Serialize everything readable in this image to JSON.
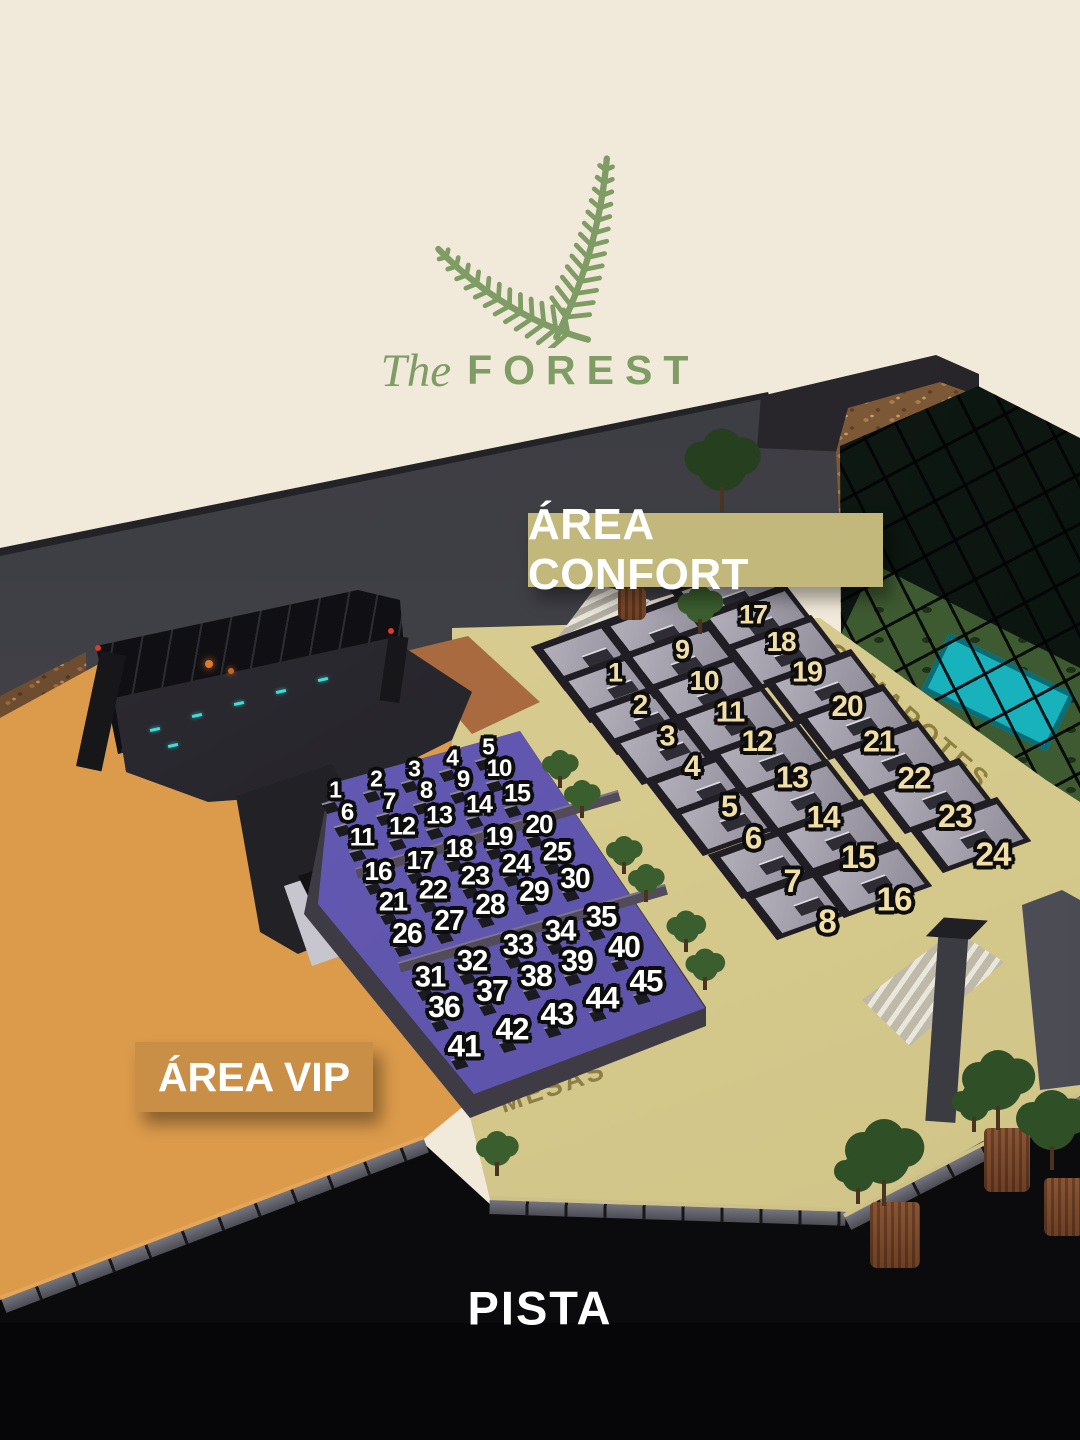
{
  "brand": {
    "prefix": "The",
    "name": "FOREST"
  },
  "banners": {
    "confort": "ÁREA CONFORT",
    "vip": "ÁREA VIP"
  },
  "floor_labels": {
    "camarotes": "CAMAROTES",
    "mesas": "MESAS",
    "pista": "PISTA"
  },
  "colors": {
    "background_cream": "#f1e9d9",
    "brand_green": "#7e9c64",
    "confort_banner": "#c3b87c",
    "vip_banner": "#c98f47",
    "orange_floor": "#dc9b4b",
    "purple_floor": "#6459b4",
    "beige_floor": "#d5c98c",
    "confort_number": "#f2dfa5",
    "vip_number": "#ffffff",
    "pista_black": "#0b0b0e",
    "pool_teal": "#18b2bc"
  },
  "vip_area": {
    "label": "ÁREA VIP",
    "tables": [
      {
        "n": 1,
        "x": 335,
        "y": 790
      },
      {
        "n": 2,
        "x": 376,
        "y": 779
      },
      {
        "n": 3,
        "x": 414,
        "y": 769
      },
      {
        "n": 4,
        "x": 452,
        "y": 758
      },
      {
        "n": 5,
        "x": 488,
        "y": 747
      },
      {
        "n": 6,
        "x": 347,
        "y": 813
      },
      {
        "n": 7,
        "x": 389,
        "y": 802
      },
      {
        "n": 8,
        "x": 426,
        "y": 791
      },
      {
        "n": 9,
        "x": 463,
        "y": 780
      },
      {
        "n": 10,
        "x": 499,
        "y": 769
      },
      {
        "n": 11,
        "x": 362,
        "y": 838
      },
      {
        "n": 12,
        "x": 402,
        "y": 827
      },
      {
        "n": 13,
        "x": 439,
        "y": 816
      },
      {
        "n": 14,
        "x": 479,
        "y": 805
      },
      {
        "n": 15,
        "x": 517,
        "y": 794
      },
      {
        "n": 16,
        "x": 378,
        "y": 871
      },
      {
        "n": 17,
        "x": 420,
        "y": 860
      },
      {
        "n": 18,
        "x": 459,
        "y": 848
      },
      {
        "n": 19,
        "x": 499,
        "y": 836
      },
      {
        "n": 20,
        "x": 539,
        "y": 824
      },
      {
        "n": 21,
        "x": 393,
        "y": 901
      },
      {
        "n": 22,
        "x": 433,
        "y": 889
      },
      {
        "n": 23,
        "x": 475,
        "y": 875
      },
      {
        "n": 24,
        "x": 516,
        "y": 863
      },
      {
        "n": 25,
        "x": 557,
        "y": 851
      },
      {
        "n": 26,
        "x": 407,
        "y": 933
      },
      {
        "n": 27,
        "x": 449,
        "y": 920
      },
      {
        "n": 28,
        "x": 490,
        "y": 904
      },
      {
        "n": 29,
        "x": 534,
        "y": 891
      },
      {
        "n": 30,
        "x": 575,
        "y": 878
      },
      {
        "n": 31,
        "x": 430,
        "y": 977
      },
      {
        "n": 32,
        "x": 472,
        "y": 961
      },
      {
        "n": 33,
        "x": 518,
        "y": 945
      },
      {
        "n": 34,
        "x": 560,
        "y": 931
      },
      {
        "n": 35,
        "x": 601,
        "y": 917
      },
      {
        "n": 36,
        "x": 444,
        "y": 1008
      },
      {
        "n": 37,
        "x": 492,
        "y": 992
      },
      {
        "n": 38,
        "x": 536,
        "y": 977
      },
      {
        "n": 39,
        "x": 577,
        "y": 962
      },
      {
        "n": 40,
        "x": 624,
        "y": 948
      },
      {
        "n": 41,
        "x": 464,
        "y": 1046
      },
      {
        "n": 42,
        "x": 512,
        "y": 1029
      },
      {
        "n": 43,
        "x": 557,
        "y": 1014
      },
      {
        "n": 44,
        "x": 602,
        "y": 998
      },
      {
        "n": 45,
        "x": 646,
        "y": 981
      }
    ]
  },
  "confort_area": {
    "label": "ÁREA CONFORT",
    "tables": [
      {
        "n": 1,
        "x": 615,
        "y": 673
      },
      {
        "n": 2,
        "x": 640,
        "y": 705
      },
      {
        "n": 3,
        "x": 667,
        "y": 737
      },
      {
        "n": 4,
        "x": 692,
        "y": 767
      },
      {
        "n": 5,
        "x": 729,
        "y": 807
      },
      {
        "n": 6,
        "x": 753,
        "y": 838
      },
      {
        "n": 7,
        "x": 792,
        "y": 881
      },
      {
        "n": 8,
        "x": 827,
        "y": 922
      },
      {
        "n": 9,
        "x": 682,
        "y": 650
      },
      {
        "n": 10,
        "x": 704,
        "y": 681
      },
      {
        "n": 11,
        "x": 730,
        "y": 713
      },
      {
        "n": 12,
        "x": 757,
        "y": 742
      },
      {
        "n": 13,
        "x": 792,
        "y": 778
      },
      {
        "n": 14,
        "x": 823,
        "y": 817
      },
      {
        "n": 15,
        "x": 858,
        "y": 857
      },
      {
        "n": 16,
        "x": 894,
        "y": 900
      },
      {
        "n": 17,
        "x": 753,
        "y": 615
      },
      {
        "n": 18,
        "x": 781,
        "y": 642
      },
      {
        "n": 19,
        "x": 807,
        "y": 673
      },
      {
        "n": 20,
        "x": 847,
        "y": 707
      },
      {
        "n": 21,
        "x": 879,
        "y": 742
      },
      {
        "n": 22,
        "x": 914,
        "y": 778
      },
      {
        "n": 23,
        "x": 955,
        "y": 816
      },
      {
        "n": 24,
        "x": 993,
        "y": 855
      }
    ]
  }
}
